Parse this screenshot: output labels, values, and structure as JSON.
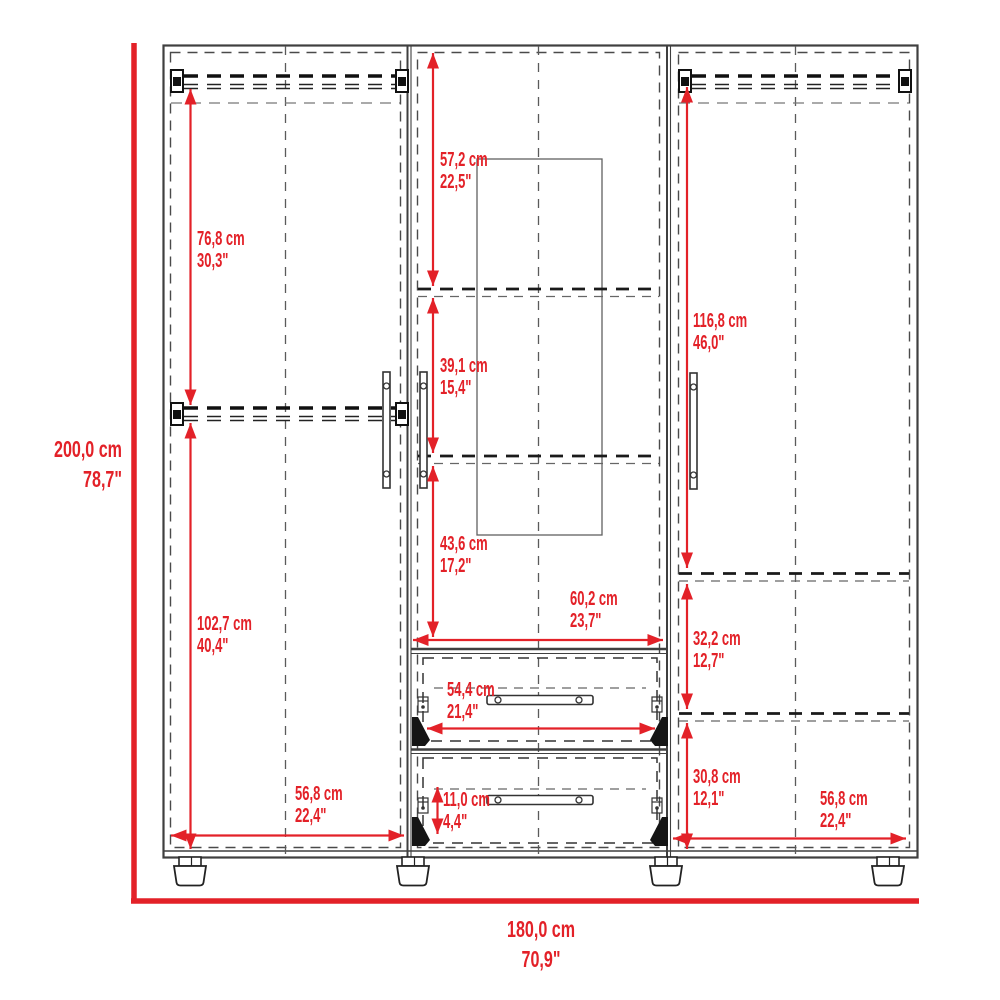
{
  "diagram": {
    "type": "furniture-dimension-drawing",
    "subject": "three-door wardrobe with mirror, hanging rods, shelves and two drawers",
    "accent_color": "#e32128",
    "line_color": "#3f3f3f",
    "overall_height": {
      "cm": "200,0 cm",
      "in": "78,7\""
    },
    "overall_width": {
      "cm": "180,0 cm",
      "in": "70,9\""
    },
    "left_upper_height": {
      "cm": "76,8 cm",
      "in": "30,3\""
    },
    "left_lower_height": {
      "cm": "102,7 cm",
      "in": "40,4\""
    },
    "middle_upper_height": {
      "cm": "57,2 cm",
      "in": "22,5\""
    },
    "middle_middle_height": {
      "cm": "39,1 cm",
      "in": "15,4\""
    },
    "middle_lower_height": {
      "cm": "43,6 cm",
      "in": "17,2\""
    },
    "right_upper_height": {
      "cm": "116,8 cm",
      "in": "46,0\""
    },
    "right_middle_height": {
      "cm": "32,2 cm",
      "in": "12,7\""
    },
    "right_lower_height": {
      "cm": "30,8 cm",
      "in": "12,1\""
    },
    "drawer_opening_width": {
      "cm": "60,2 cm",
      "in": "23,7\""
    },
    "drawer_inner_width": {
      "cm": "54,4 cm",
      "in": "21,4\""
    },
    "drawer_front_height": {
      "cm": "11,0 cm",
      "in": "4,4\""
    },
    "left_section_width": {
      "cm": "56,8 cm",
      "in": "22,4\""
    },
    "right_section_width": {
      "cm": "56,8 cm",
      "in": "22,4\""
    }
  }
}
